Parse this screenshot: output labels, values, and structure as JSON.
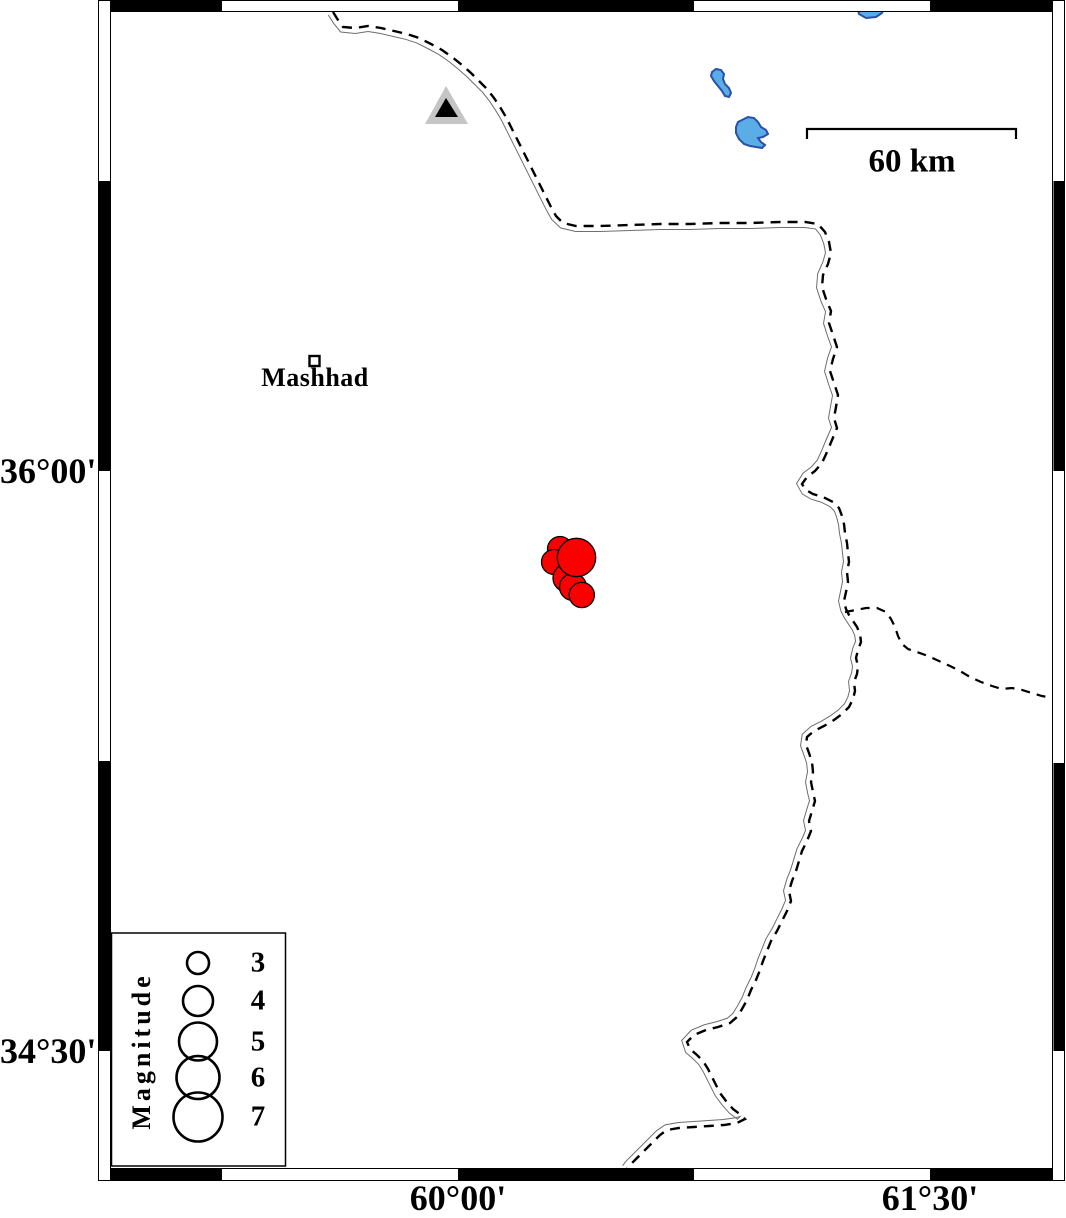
{
  "axis": {
    "left": [
      {
        "label": "36°00'",
        "y": 471
      },
      {
        "label": "34°30'",
        "y": 1051
      }
    ],
    "bottom": [
      {
        "label": "60°00'",
        "x": 458
      },
      {
        "label": "61°30'",
        "x": 930
      }
    ]
  },
  "scale_bar": {
    "label": "60 km",
    "x1": 807,
    "x2": 1016,
    "y": 129,
    "tick": 10,
    "label_x": 912,
    "label_y": 162
  },
  "city": {
    "label": "Mashhad",
    "marker": {
      "x": 309.5,
      "y": 356,
      "size": 10
    },
    "label_x": 315,
    "label_y": 378
  },
  "station": {
    "outer": [
      [
        446,
        86
      ],
      [
        468,
        124
      ],
      [
        425,
        124
      ]
    ],
    "inner": [
      [
        446,
        98
      ],
      [
        458,
        117
      ],
      [
        435,
        117
      ]
    ]
  },
  "lakes": [
    [
      [
        857,
        6
      ],
      [
        868,
        3
      ],
      [
        878,
        4
      ],
      [
        884,
        8
      ],
      [
        882,
        13
      ],
      [
        876,
        17
      ],
      [
        866,
        18
      ],
      [
        859,
        14
      ]
    ],
    [
      [
        712,
        72
      ],
      [
        716,
        69
      ],
      [
        721,
        70
      ],
      [
        724,
        74
      ],
      [
        723,
        79
      ],
      [
        725,
        84
      ],
      [
        729,
        88
      ],
      [
        731,
        93
      ],
      [
        729,
        97
      ],
      [
        725,
        96
      ],
      [
        722,
        91
      ],
      [
        718,
        86
      ],
      [
        714,
        81
      ],
      [
        711,
        76
      ]
    ],
    [
      [
        742,
        120
      ],
      [
        748,
        117
      ],
      [
        754,
        118
      ],
      [
        758,
        122
      ],
      [
        761,
        127
      ],
      [
        766,
        130
      ],
      [
        768,
        134
      ],
      [
        763,
        137
      ],
      [
        758,
        138
      ],
      [
        761,
        142
      ],
      [
        765,
        145
      ],
      [
        762,
        148
      ],
      [
        756,
        147
      ],
      [
        750,
        146
      ],
      [
        744,
        144
      ],
      [
        739,
        139
      ],
      [
        736,
        133
      ],
      [
        736,
        127
      ],
      [
        738,
        122
      ]
    ]
  ],
  "border_main": [
    [
      333,
      12
    ],
    [
      338,
      20
    ],
    [
      343,
      27
    ],
    [
      355,
      28
    ],
    [
      368,
      26
    ],
    [
      381,
      28
    ],
    [
      394,
      31
    ],
    [
      407,
      34
    ],
    [
      419,
      38
    ],
    [
      431,
      44
    ],
    [
      442,
      50
    ],
    [
      452,
      57
    ],
    [
      462,
      65
    ],
    [
      471,
      73
    ],
    [
      479,
      81
    ],
    [
      487,
      89
    ],
    [
      494,
      98
    ],
    [
      500,
      107
    ],
    [
      506,
      117
    ],
    [
      511,
      127
    ],
    [
      516,
      137
    ],
    [
      521,
      147
    ],
    [
      526,
      157
    ],
    [
      531,
      167
    ],
    [
      536,
      177
    ],
    [
      541,
      187
    ],
    [
      546,
      197
    ],
    [
      551,
      207
    ],
    [
      556,
      216
    ],
    [
      563,
      223
    ],
    [
      576,
      226
    ],
    [
      600,
      226
    ],
    [
      630,
      225
    ],
    [
      660,
      224
    ],
    [
      690,
      224
    ],
    [
      720,
      223
    ],
    [
      750,
      223
    ],
    [
      780,
      222
    ],
    [
      805,
      222
    ],
    [
      818,
      224
    ],
    [
      825,
      232
    ],
    [
      829,
      242
    ],
    [
      831,
      253
    ],
    [
      828,
      264
    ],
    [
      823,
      275
    ],
    [
      822,
      287
    ],
    [
      826,
      299
    ],
    [
      831,
      311
    ],
    [
      829,
      323
    ],
    [
      833,
      335
    ],
    [
      837,
      347
    ],
    [
      833,
      359
    ],
    [
      830,
      371
    ],
    [
      834,
      383
    ],
    [
      838,
      395
    ],
    [
      836,
      407
    ],
    [
      834,
      418
    ],
    [
      837,
      428
    ],
    [
      832,
      440
    ],
    [
      827,
      452
    ],
    [
      822,
      463
    ],
    [
      815,
      471
    ],
    [
      807,
      477
    ],
    [
      802,
      484
    ],
    [
      806,
      490
    ],
    [
      813,
      494
    ],
    [
      823,
      497
    ],
    [
      833,
      502
    ],
    [
      839,
      508
    ],
    [
      842,
      516
    ],
    [
      844,
      524
    ],
    [
      845,
      533
    ],
    [
      847,
      543
    ],
    [
      848,
      553
    ],
    [
      849,
      562
    ],
    [
      847,
      572
    ],
    [
      848,
      582
    ],
    [
      846,
      592
    ],
    [
      844,
      601
    ],
    [
      846,
      609
    ],
    [
      849,
      615
    ],
    [
      853,
      621
    ],
    [
      857,
      627
    ],
    [
      860,
      634
    ],
    [
      861,
      642
    ],
    [
      858,
      650
    ],
    [
      856,
      658
    ],
    [
      858,
      666
    ],
    [
      857,
      674
    ],
    [
      854,
      682
    ],
    [
      855,
      691
    ],
    [
      853,
      699
    ],
    [
      849,
      707
    ],
    [
      842,
      714
    ],
    [
      834,
      720
    ],
    [
      824,
      726
    ],
    [
      814,
      731
    ],
    [
      807,
      737
    ],
    [
      806,
      745
    ],
    [
      809,
      753
    ],
    [
      812,
      762
    ],
    [
      813,
      772
    ],
    [
      811,
      782
    ],
    [
      813,
      792
    ],
    [
      815,
      801
    ],
    [
      812,
      811
    ],
    [
      809,
      821
    ],
    [
      811,
      831
    ],
    [
      807,
      841
    ],
    [
      802,
      851
    ],
    [
      799,
      861
    ],
    [
      796,
      871
    ],
    [
      792,
      881
    ],
    [
      789,
      891
    ],
    [
      791,
      901
    ],
    [
      787,
      911
    ],
    [
      782,
      921
    ],
    [
      777,
      931
    ],
    [
      771,
      941
    ],
    [
      767,
      951
    ],
    [
      763,
      961
    ],
    [
      760,
      970
    ],
    [
      756,
      980
    ],
    [
      751,
      990
    ],
    [
      747,
      1000
    ],
    [
      742,
      1009
    ],
    [
      737,
      1017
    ],
    [
      730,
      1023
    ],
    [
      718,
      1027
    ],
    [
      706,
      1030
    ],
    [
      694,
      1035
    ],
    [
      687,
      1042
    ],
    [
      690,
      1049
    ],
    [
      697,
      1055
    ],
    [
      703,
      1061
    ],
    [
      708,
      1069
    ],
    [
      712,
      1077
    ],
    [
      716,
      1085
    ],
    [
      720,
      1093
    ],
    [
      726,
      1101
    ],
    [
      733,
      1109
    ],
    [
      741,
      1115
    ],
    [
      745,
      1119
    ],
    [
      737,
      1123
    ],
    [
      724,
      1125
    ],
    [
      709,
      1126
    ],
    [
      694,
      1127
    ],
    [
      679,
      1128
    ],
    [
      667,
      1130
    ],
    [
      660,
      1135
    ],
    [
      654,
      1141
    ],
    [
      648,
      1147
    ],
    [
      642,
      1153
    ],
    [
      636,
      1159
    ],
    [
      630,
      1165
    ],
    [
      627,
      1169
    ]
  ],
  "border_branch": [
    [
      845,
      612
    ],
    [
      856,
      610
    ],
    [
      866,
      608
    ],
    [
      877,
      608
    ],
    [
      886,
      612
    ],
    [
      891,
      619
    ],
    [
      895,
      627
    ],
    [
      898,
      636
    ],
    [
      902,
      644
    ],
    [
      908,
      649
    ],
    [
      917,
      652
    ],
    [
      928,
      656
    ],
    [
      939,
      661
    ],
    [
      950,
      666
    ],
    [
      960,
      671
    ],
    [
      970,
      677
    ],
    [
      981,
      682
    ],
    [
      992,
      686
    ],
    [
      1002,
      689
    ],
    [
      1012,
      688
    ],
    [
      1022,
      690
    ],
    [
      1032,
      693
    ],
    [
      1042,
      696
    ],
    [
      1053,
      698
    ]
  ],
  "earthquakes": [
    {
      "cx": 560,
      "cy": 549,
      "r": 12.5
    },
    {
      "cx": 554,
      "cy": 562,
      "r": 12.5
    },
    {
      "cx": 567,
      "cy": 578,
      "r": 14
    },
    {
      "cx": 573,
      "cy": 587,
      "r": 13.5
    },
    {
      "cx": 576.5,
      "cy": 557.5,
      "r": 19.2
    },
    {
      "cx": 581.8,
      "cy": 595,
      "r": 12.6
    }
  ],
  "legend": {
    "title": "Magnitude",
    "box": {
      "x": 111.5,
      "y": 933,
      "w": 174,
      "h": 233
    },
    "circle_x": 198,
    "entries": [
      {
        "label": "3",
        "cy": 963,
        "r": 11
      },
      {
        "label": "4",
        "cy": 1001,
        "r": 15
      },
      {
        "label": "5",
        "cy": 1041.5,
        "r": 19
      },
      {
        "label": "6",
        "cy": 1077.5,
        "r": 21.5
      },
      {
        "label": "7",
        "cy": 1117,
        "r": 24.5
      }
    ]
  },
  "frame": {
    "top_black": [
      [
        110,
        222
      ],
      [
        458,
        694
      ],
      [
        930,
        1053
      ]
    ],
    "bottom_black": [
      [
        110,
        222
      ],
      [
        458,
        694
      ],
      [
        930,
        1053
      ]
    ],
    "left_black": [
      [
        181,
        471
      ],
      [
        761,
        1051
      ]
    ],
    "right_black": [
      [
        181,
        471
      ],
      [
        763,
        1051
      ]
    ]
  },
  "colors": {
    "lake_fill": "#5aade6",
    "lake_stroke": "#2b50a8",
    "earthquake_fill": "#fa0000",
    "triangle_fill": "#c5c5c5",
    "triangle_inner": "#000000",
    "border": "#000000",
    "companion_line": "#6e6e6e"
  }
}
